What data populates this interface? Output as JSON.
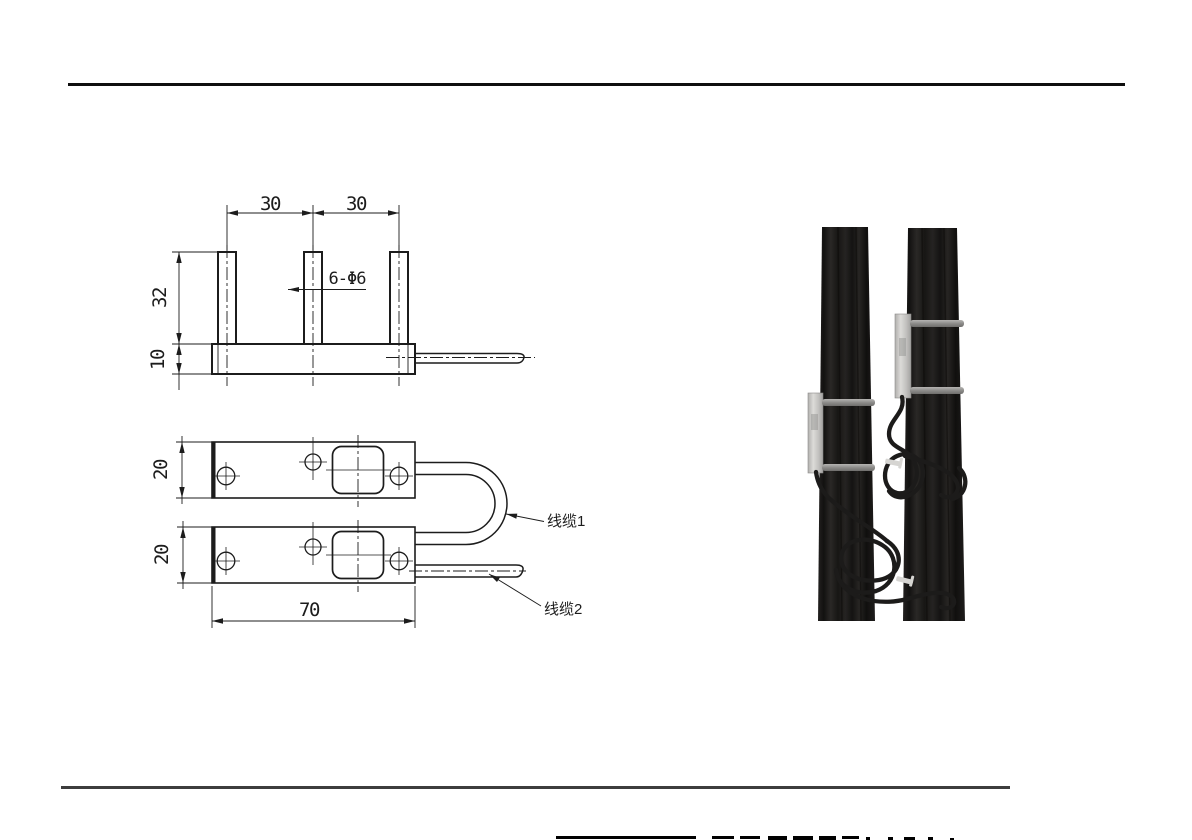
{
  "page": {
    "background": "#ffffff",
    "top_rule_color": "#0e0e0e",
    "bottom_rule_color": "#3d3d3d"
  },
  "drawing": {
    "line_color": "#1c1c1c",
    "front_view": {
      "dim_spacing_left": "30",
      "dim_spacing_right": "30",
      "dim_pin_height": "32",
      "dim_base_thickness": "10",
      "hole_callout": "6-Φ6"
    },
    "top_view": {
      "dim_plate1_width": "20",
      "dim_plate2_width": "20",
      "dim_overall_length": "70",
      "cable1_label": "线缆1",
      "cable2_label": "线缆2"
    }
  },
  "photo": {
    "belt_color": "#1c1a19",
    "sensor_color": "#c9c8c6",
    "pin_color": "#8d8c8a",
    "cable_color": "#1c1b1a",
    "zip_tie_color": "#d6d5d2"
  }
}
